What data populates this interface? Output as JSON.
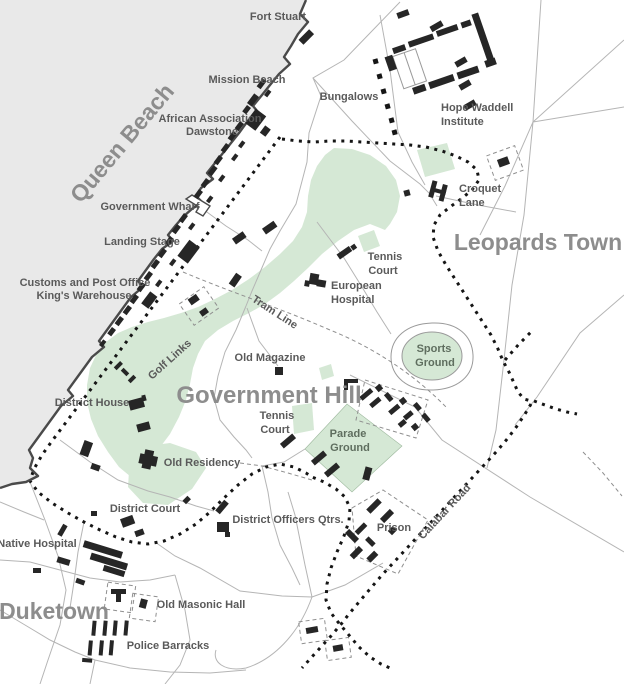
{
  "map": {
    "region_labels": {
      "queen_beach": "Queen Beach",
      "leopards_town": "Leopards Town",
      "government_hill": "Government Hill",
      "duketown": "Duketown"
    },
    "road_labels": {
      "tram_line": "Tram Line",
      "calabar_road": "Calabar Road"
    },
    "place_labels": {
      "fort_stuart": "Fort Stuart",
      "mission_beach": "Mission Beach",
      "african_association_line1": "African Association",
      "african_association_line2": "Dawstone",
      "bungalows": "Bungalows",
      "hope_waddell_line1": "Hope Waddell",
      "hope_waddell_line2": "Institute",
      "croquet_line1": "Croquet",
      "croquet_line2": "Lane",
      "government_wharf": "Government Wharf",
      "landing_stage": "Landing Stage",
      "customs_line1": "Customs and Post Office",
      "customs_line2": "King's Warehouse",
      "tennis_court_upper_line1": "Tennis",
      "tennis_court_upper_line2": "Court",
      "european_hospital_line1": "European",
      "european_hospital_line2": "Hospital",
      "old_magazine": "Old Magazine",
      "sports_ground_line1": "Sports",
      "sports_ground_line2": "Ground",
      "golf_links": "Golf Links",
      "district_house": "District House",
      "tennis_court_lower_line1": "Tennis",
      "tennis_court_lower_line2": "Court",
      "parade_ground_line1": "Parade",
      "parade_ground_line2": "Ground",
      "old_residency": "Old Residency",
      "district_court": "District Court",
      "district_officers_qtrs": "District Officers Qtrs.",
      "native_hospital": "Native Hospital",
      "prison": "Prison",
      "old_masonic_hall": "Old Masonic Hall",
      "police_barracks": "Police Barracks"
    },
    "colors": {
      "water": "#e9e9e9",
      "land": "#ffffff",
      "parkland_green": "#d5e8d5",
      "building_black": "#262626",
      "coastline_gray": "#4a4a4a",
      "road_gray": "#b5b5b5",
      "dotted_road_black": "#151515",
      "dashed_line_gray": "#8f8f8f",
      "place_label_gray": "#5a5a5a",
      "region_label_gray": "#8d8d8d"
    }
  }
}
